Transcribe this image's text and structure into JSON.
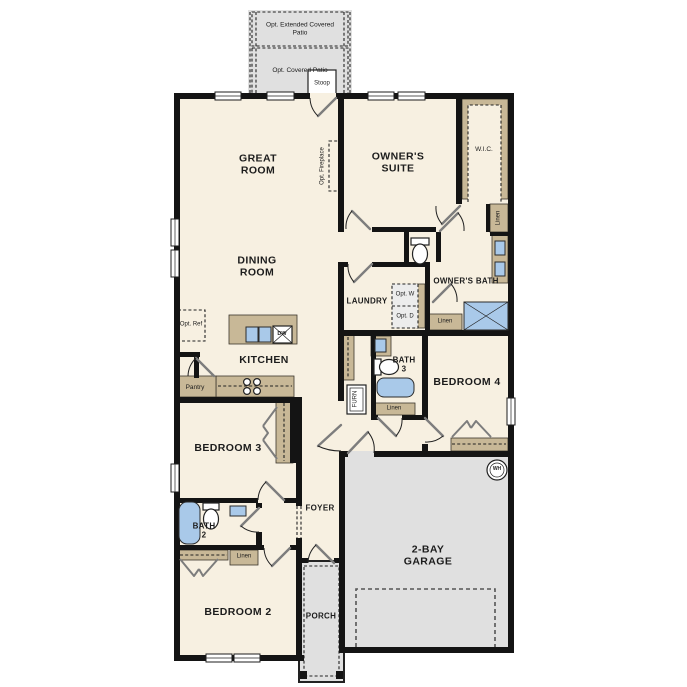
{
  "palette": {
    "floor": "#f7f0e1",
    "wall": "#141414",
    "tan": "#c8b897",
    "blue": "#a9c9e9",
    "gray": "#e0e0e0",
    "lgray": "#ececec",
    "leaf": "#7d7d7d"
  },
  "labels": {
    "opt_extended_patio": "Opt. Extended Covered Patio",
    "opt_covered_patio": "Opt. Covered Patio",
    "stoop": "Stoop",
    "great_room": "GREAT ROOM",
    "owners_suite": "OWNER'S SUITE",
    "wic": "W.I.C.",
    "linen_hall": "Linen",
    "opt_fireplace": "Opt. Fireplace",
    "dining_room": "DINING ROOM",
    "owners_bath": "OWNER'S BATH",
    "laundry": "LAUNDRY",
    "opt_washer": "Opt. W",
    "opt_dryer": "Opt. D",
    "linen_owners_bath": "Linen",
    "opt_ref": "Opt. Ref",
    "kitchen": "KITCHEN",
    "pantry": "Pantry",
    "dw": "DW",
    "bath_3": "BATH 3",
    "linen_bath3": "Linen",
    "furn": "FURN",
    "bedroom_4": "BEDROOM 4",
    "bedroom_3": "BEDROOM 3",
    "foyer": "FOYER",
    "bath_2": "BATH 2",
    "linen_bath2": "Linen",
    "bedroom_2": "BEDROOM 2",
    "porch": "PORCH",
    "garage": "2-BAY GARAGE",
    "wh": "WH"
  }
}
